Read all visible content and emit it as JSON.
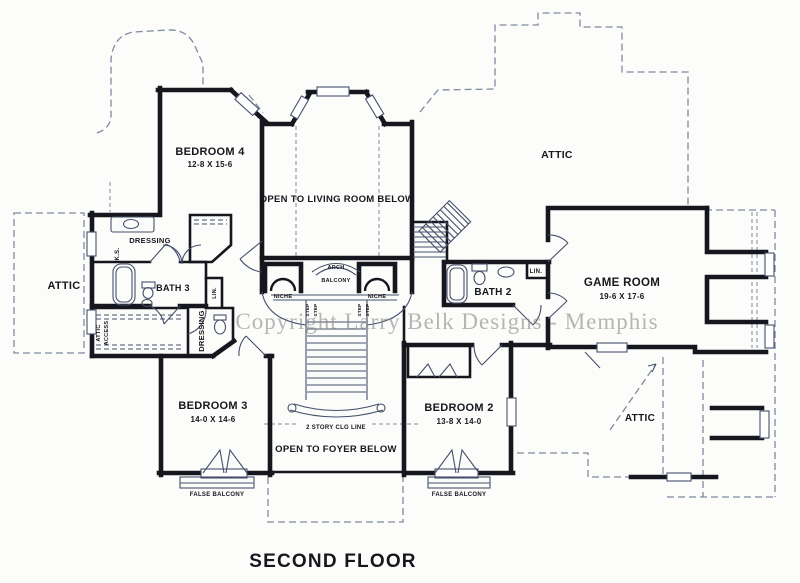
{
  "drawing_title": "SECOND FLOOR",
  "watermark": "Copyright Larry Belk Designs - Memphis",
  "rooms": {
    "bedroom_4": {
      "name": "BEDROOM 4",
      "dims": "12-8 X 15-6"
    },
    "bedroom_3": {
      "name": "BEDROOM 3",
      "dims": "14-0 X 14-6"
    },
    "bedroom_2": {
      "name": "BEDROOM 2",
      "dims": "13-8 X 14-0"
    },
    "game_room": {
      "name": "GAME ROOM",
      "dims": "19-6 X 17-6"
    },
    "bath_2": {
      "name": "BATH 2"
    },
    "bath_3": {
      "name": "BATH 3"
    },
    "attic_left": {
      "name": "ATTIC"
    },
    "attic_top_right": {
      "name": "ATTIC"
    },
    "attic_bottom_right": {
      "name": "ATTIC"
    },
    "dressing_upper": {
      "name": "DRESSING"
    },
    "dressing_lower": {
      "name": "DRESSING"
    },
    "open_to_living": {
      "name": "OPEN TO LIVING ROOM BELOW"
    },
    "open_to_foyer": {
      "name": "OPEN TO FOYER BELOW"
    }
  },
  "annotations": {
    "arch": "ARCH",
    "balcony": "BALCONY",
    "niche": "NICHE",
    "step": "STEP",
    "knee_space": "K.S.",
    "linen_left": "LIN.",
    "linen_right": "LIN.",
    "attic_access_line1": "ATTIC",
    "attic_access_line2": "ACCESS",
    "two_story_ceiling": "2 STORY CLG LINE",
    "false_balcony": "FALSE BALCONY"
  },
  "colors": {
    "paper": "#fcfcfa",
    "ink": "#16161e",
    "thin_line": "#45506b",
    "dash_line": "#7e8aa0",
    "watermark": "#8a8a8a"
  }
}
